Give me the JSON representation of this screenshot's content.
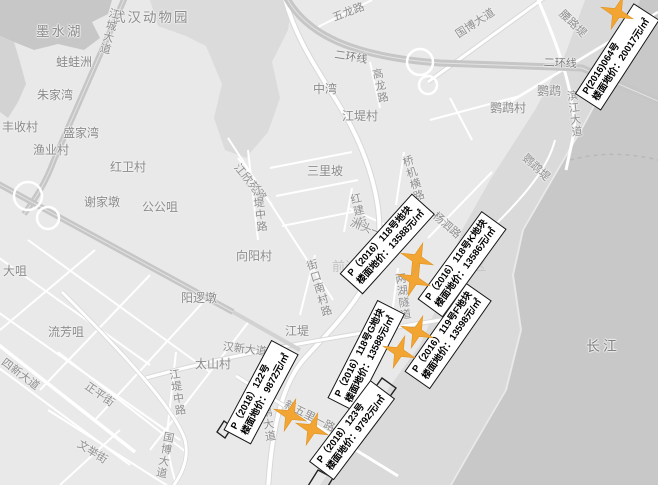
{
  "colors": {
    "land": "#E9E9E9",
    "water": "#C8C8C8",
    "bank": "#DADADA",
    "forest": "#DBDBDB",
    "road": "#FFFFFF",
    "highway": "#C9C9C9",
    "star": "#F2A533",
    "box_border": "#141414",
    "map_text": "#8C8C8C"
  },
  "map_labels": [
    {
      "text": "墨水湖"
    },
    {
      "text": "武汉动物园"
    },
    {
      "text": "蛙蛙洲"
    },
    {
      "text": "朱家湾"
    },
    {
      "text": "丰收村"
    },
    {
      "text": "盛家湾"
    },
    {
      "text": "渔业村"
    },
    {
      "text": "红卫村"
    },
    {
      "text": "谢家墩"
    },
    {
      "text": "公公咀"
    },
    {
      "text": "大咀"
    },
    {
      "text": "阳逻墩"
    },
    {
      "text": "流芳咀"
    },
    {
      "text": "太山村"
    },
    {
      "text": "向阳村"
    },
    {
      "text": "三里坡"
    },
    {
      "text": "中湾"
    },
    {
      "text": "江堤村"
    },
    {
      "text": "鹦鹉村"
    },
    {
      "text": "鹦鹉"
    },
    {
      "text": "长江"
    },
    {
      "text": "江堤"
    },
    {
      "text": "前进村"
    },
    {
      "text": "汉阳区"
    }
  ],
  "road_labels": [
    {
      "text": "江城大道"
    },
    {
      "text": "五龙路"
    },
    {
      "text": "二环线"
    },
    {
      "text": "二环线"
    },
    {
      "text": "高龙路"
    },
    {
      "text": "国博大道"
    },
    {
      "text": "腰路堤"
    },
    {
      "text": "滨江大道"
    },
    {
      "text": "鹦鹉堤"
    },
    {
      "text": "杨泗路"
    },
    {
      "text": "桥机横路"
    },
    {
      "text": "红建街"
    },
    {
      "text": "洲头一街"
    },
    {
      "text": "江欣苑路"
    },
    {
      "text": "江堤中路"
    },
    {
      "text": "街口南村路"
    },
    {
      "text": "两湖隧道"
    },
    {
      "text": "鹦鹉大道"
    },
    {
      "text": "新五里一路"
    },
    {
      "text": "汉新大道"
    },
    {
      "text": "四新大道"
    },
    {
      "text": "正平街"
    },
    {
      "text": "文举街"
    },
    {
      "text": "江堤中路"
    },
    {
      "text": "国博大道"
    }
  ],
  "price_labels": [
    {
      "line1": "P(2016)064号",
      "line2": "楼面地价：20017元/㎡"
    },
    {
      "line1": "P（2016）118号地块",
      "line2": "楼面地价：13588元/㎡"
    },
    {
      "line1": "P（2016）118号K地块",
      "line2": "楼面地价：13586元/㎡"
    },
    {
      "line1": "P（2016）118号G地块",
      "line2": "楼面地价：13588元/㎡"
    },
    {
      "line1": "P（2016）119号F地块",
      "line2": "楼面地价：13598元/㎡"
    },
    {
      "line1": "P（2018）122号",
      "line2": "楼面地价：9872元/㎡"
    },
    {
      "line1": "P（2018）123号",
      "line2": "楼面地价：9792元/㎡"
    }
  ],
  "markers": [
    {
      "x": 617,
      "y": 13
    },
    {
      "x": 417,
      "y": 259
    },
    {
      "x": 414,
      "y": 280
    },
    {
      "x": 417,
      "y": 332
    },
    {
      "x": 399,
      "y": 352
    },
    {
      "x": 290,
      "y": 415
    },
    {
      "x": 312,
      "y": 429
    }
  ]
}
